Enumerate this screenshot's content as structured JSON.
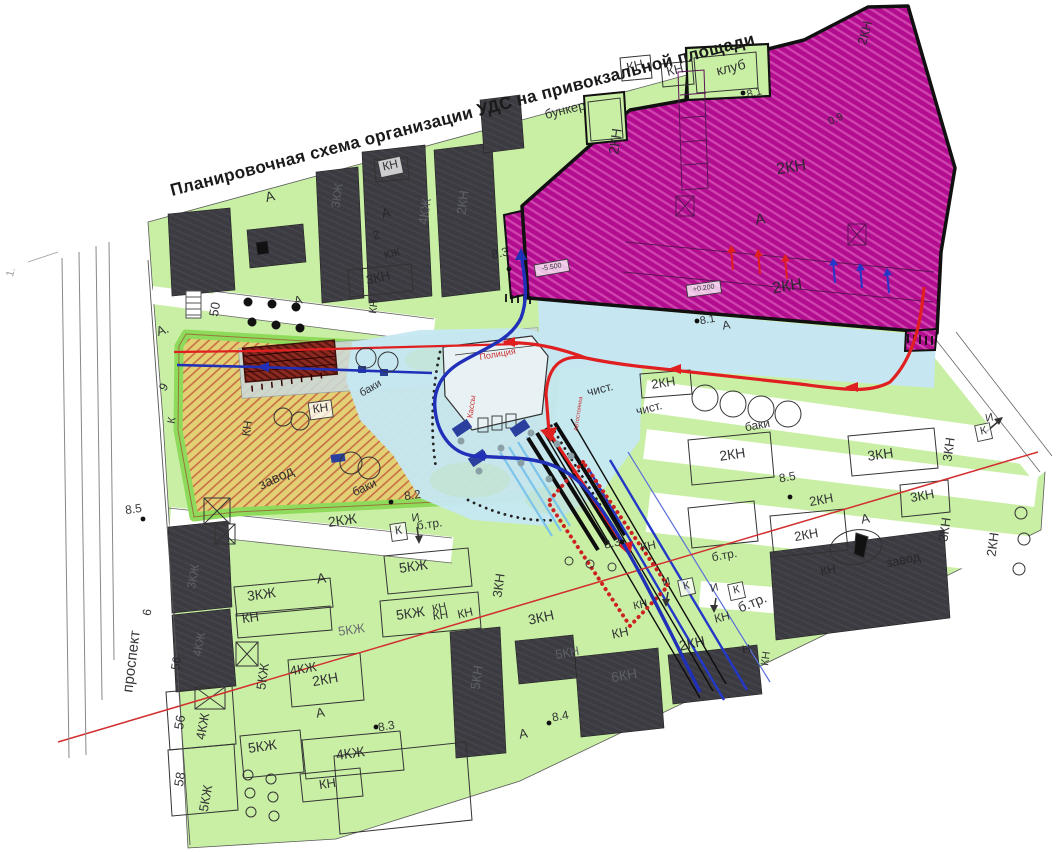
{
  "title": "Планировочная схема организации УДС на привокзальной площади",
  "colors": {
    "green_area": "#c9efa5",
    "magenta_zone": "#b10d8e",
    "magenta_stripe": "#cf43ae",
    "dark_building": "#3b3b41",
    "factory_yellow": "#e3cf74",
    "factory_hatch_red": "#c2563a",
    "plaza_blue": "#c6e7f1",
    "route_red": "#e02020",
    "route_blue": "#2030b8",
    "rail_black": "#0d0d0d",
    "fence_red_chain": "#cc2222",
    "label_ink": "#26262a"
  },
  "map": {
    "labels": [
      {
        "t": "клуб",
        "x": 732,
        "y": 72,
        "r": -14,
        "s": 14
      },
      {
        "t": "КН",
        "x": 636,
        "y": 70,
        "r": -14,
        "s": 13
      },
      {
        "t": "КН",
        "x": 676,
        "y": 74,
        "r": -14,
        "s": 13
      },
      {
        "t": "8.1",
        "x": 755,
        "y": 96,
        "r": -14,
        "s": 11
      },
      {
        "t": "бункер",
        "x": 566,
        "y": 114,
        "r": -14,
        "s": 13
      },
      {
        "t": "2КН",
        "x": 620,
        "y": 142,
        "r": -82,
        "s": 14
      },
      {
        "t": "2КН",
        "x": 869,
        "y": 34,
        "r": -75,
        "s": 13
      },
      {
        "t": "0.9",
        "x": 837,
        "y": 122,
        "r": -24,
        "s": 11
      },
      {
        "t": "2КН",
        "x": 792,
        "y": 172,
        "r": -9,
        "s": 16
      },
      {
        "t": "А",
        "x": 761,
        "y": 224,
        "r": -9,
        "s": 15
      },
      {
        "t": "2КН",
        "x": 788,
        "y": 291,
        "r": -9,
        "s": 16
      },
      {
        "t": "8.1",
        "x": 708,
        "y": 323,
        "r": -10,
        "s": 11
      },
      {
        "t": "А",
        "x": 727,
        "y": 329,
        "r": -10,
        "s": 12
      },
      {
        "t": "8.3",
        "x": 501,
        "y": 257,
        "r": -14,
        "s": 12
      },
      {
        "t": "2КН",
        "x": 664,
        "y": 387,
        "r": -9,
        "s": 13
      },
      {
        "t": "чист.",
        "x": 601,
        "y": 393,
        "r": -14,
        "s": 12
      },
      {
        "t": "чист.",
        "x": 650,
        "y": 412,
        "r": -14,
        "s": 12
      },
      {
        "t": "баки",
        "x": 758,
        "y": 429,
        "r": -10,
        "s": 12
      },
      {
        "t": "3КН",
        "x": 881,
        "y": 459,
        "r": -8,
        "s": 14
      },
      {
        "t": "2КН",
        "x": 733,
        "y": 459,
        "r": -8,
        "s": 14
      },
      {
        "t": "8.5",
        "x": 788,
        "y": 481,
        "r": -10,
        "s": 12
      },
      {
        "t": "2КН",
        "x": 822,
        "y": 504,
        "r": -10,
        "s": 13
      },
      {
        "t": "3КН",
        "x": 923,
        "y": 500,
        "r": -10,
        "s": 13
      },
      {
        "t": "3КН",
        "x": 953,
        "y": 450,
        "r": -82,
        "s": 13
      },
      {
        "t": "3КН",
        "x": 949,
        "y": 530,
        "r": -82,
        "s": 13
      },
      {
        "t": "2КН",
        "x": 997,
        "y": 545,
        "r": -82,
        "s": 13
      },
      {
        "t": "А",
        "x": 866,
        "y": 523,
        "r": -10,
        "s": 13
      },
      {
        "t": "завод",
        "x": 904,
        "y": 564,
        "r": -12,
        "s": 13
      },
      {
        "t": "КН",
        "x": 829,
        "y": 574,
        "r": -12,
        "s": 12
      },
      {
        "t": "2КН",
        "x": 807,
        "y": 539,
        "r": -10,
        "s": 13
      },
      {
        "t": "б.тр.",
        "x": 725,
        "y": 559,
        "r": -10,
        "s": 12
      },
      {
        "t": "КН",
        "x": 723,
        "y": 621,
        "r": -14,
        "s": 12
      },
      {
        "t": "б.тр.",
        "x": 754,
        "y": 607,
        "r": -22,
        "s": 14
      },
      {
        "t": "Н",
        "x": 747,
        "y": 653,
        "r": -10,
        "s": 12
      },
      {
        "t": "КН",
        "x": 769,
        "y": 659,
        "r": -82,
        "s": 11
      },
      {
        "t": "2КН",
        "x": 693,
        "y": 648,
        "r": -12,
        "s": 14
      },
      {
        "t": "6КН",
        "x": 625,
        "y": 680,
        "r": -10,
        "s": 14,
        "c": "dk"
      },
      {
        "t": "5КН",
        "x": 568,
        "y": 657,
        "r": -10,
        "s": 13,
        "c": "dk"
      },
      {
        "t": "5КН",
        "x": 481,
        "y": 678,
        "r": -82,
        "s": 13,
        "c": "dk"
      },
      {
        "t": "8.4",
        "x": 561,
        "y": 720,
        "r": -10,
        "s": 12
      },
      {
        "t": "А",
        "x": 524,
        "y": 738,
        "r": -10,
        "s": 13
      },
      {
        "t": "КН",
        "x": 621,
        "y": 637,
        "r": -12,
        "s": 13
      },
      {
        "t": "3КН",
        "x": 542,
        "y": 622,
        "r": -12,
        "s": 14
      },
      {
        "t": "КН",
        "x": 466,
        "y": 617,
        "r": -12,
        "s": 12
      },
      {
        "t": "КН",
        "x": 440,
        "y": 611,
        "r": -12,
        "s": 11
      },
      {
        "t": "3КН",
        "x": 503,
        "y": 586,
        "r": -82,
        "s": 13
      },
      {
        "t": "8.3",
        "x": 613,
        "y": 547,
        "r": -12,
        "s": 12
      },
      {
        "t": "КН",
        "x": 649,
        "y": 550,
        "r": -12,
        "s": 12
      },
      {
        "t": "КН",
        "x": 641,
        "y": 608,
        "r": -12,
        "s": 11
      },
      {
        "t": "И",
        "x": 667,
        "y": 585,
        "r": -12,
        "s": 11
      },
      {
        "t": "К",
        "x": 687,
        "y": 589,
        "r": -12,
        "s": 11,
        "box": 1
      },
      {
        "t": "И",
        "x": 715,
        "y": 591,
        "r": -12,
        "s": 11
      },
      {
        "t": "К",
        "x": 737,
        "y": 593,
        "r": -12,
        "s": 11,
        "box": 1
      },
      {
        "t": "б.тр.",
        "x": 430,
        "y": 528,
        "r": -8,
        "s": 12
      },
      {
        "t": "И",
        "x": 416,
        "y": 521,
        "r": -8,
        "s": 11
      },
      {
        "t": "К",
        "x": 399,
        "y": 534,
        "r": -8,
        "s": 12,
        "box": 1
      },
      {
        "t": "2КЖ",
        "x": 343,
        "y": 525,
        "r": -8,
        "s": 14
      },
      {
        "t": "8.5",
        "x": 134,
        "y": 513,
        "r": -8,
        "s": 12
      },
      {
        "t": "А",
        "x": 322,
        "y": 583,
        "r": -8,
        "s": 14
      },
      {
        "t": "5КЖ",
        "x": 414,
        "y": 571,
        "r": -8,
        "s": 14
      },
      {
        "t": "3КЖ",
        "x": 262,
        "y": 599,
        "r": -8,
        "s": 14
      },
      {
        "t": "КН",
        "x": 251,
        "y": 622,
        "r": -8,
        "s": 13
      },
      {
        "t": "5КЖ",
        "x": 411,
        "y": 618,
        "r": -8,
        "s": 14
      },
      {
        "t": "КН",
        "x": 441,
        "y": 619,
        "r": -8,
        "s": 12
      },
      {
        "t": "5КЖ",
        "x": 352,
        "y": 634,
        "r": -8,
        "s": 13,
        "c": "dk"
      },
      {
        "t": "2КН",
        "x": 326,
        "y": 684,
        "r": -10,
        "s": 14
      },
      {
        "t": "4КЖ",
        "x": 304,
        "y": 673,
        "r": -10,
        "s": 13
      },
      {
        "t": "5КЖ",
        "x": 267,
        "y": 677,
        "r": -82,
        "s": 13
      },
      {
        "t": "А",
        "x": 321,
        "y": 717,
        "r": -10,
        "s": 13
      },
      {
        "t": "8.3",
        "x": 387,
        "y": 730,
        "r": -10,
        "s": 12
      },
      {
        "t": "5КЖ",
        "x": 263,
        "y": 751,
        "r": -8,
        "s": 14
      },
      {
        "t": "4КЖ",
        "x": 351,
        "y": 758,
        "r": -8,
        "s": 14
      },
      {
        "t": "КН",
        "x": 328,
        "y": 788,
        "r": -8,
        "s": 13
      },
      {
        "t": "56",
        "x": 184,
        "y": 723,
        "r": -80,
        "s": 13
      },
      {
        "t": "4КЖ",
        "x": 207,
        "y": 727,
        "r": -80,
        "s": 13
      },
      {
        "t": "58",
        "x": 184,
        "y": 780,
        "r": -80,
        "s": 13
      },
      {
        "t": "5КЖ",
        "x": 210,
        "y": 799,
        "r": -80,
        "s": 13
      },
      {
        "t": "56",
        "x": 180,
        "y": 664,
        "r": -80,
        "s": 12
      },
      {
        "t": "3КЖ",
        "x": 197,
        "y": 577,
        "r": -80,
        "s": 12,
        "c": "dk"
      },
      {
        "t": "4КЖ",
        "x": 203,
        "y": 645,
        "r": -80,
        "s": 12,
        "c": "dk"
      },
      {
        "t": "проспект",
        "x": 136,
        "y": 662,
        "r": -83,
        "s": 15
      },
      {
        "t": "6",
        "x": 151,
        "y": 613,
        "r": -80,
        "s": 12
      },
      {
        "t": "А.",
        "x": 164,
        "y": 334,
        "r": -20,
        "s": 13
      },
      {
        "t": "9",
        "x": 167,
        "y": 389,
        "r": -60,
        "s": 12
      },
      {
        "t": "К",
        "x": 175,
        "y": 421,
        "r": -80,
        "s": 11
      },
      {
        "t": "50",
        "x": 219,
        "y": 310,
        "r": -80,
        "s": 13
      },
      {
        "t": "А",
        "x": 271,
        "y": 201,
        "r": -14,
        "s": 14
      },
      {
        "t": "А",
        "x": 387,
        "y": 217,
        "r": -14,
        "s": 13
      },
      {
        "t": "2",
        "x": 377,
        "y": 239,
        "r": -14,
        "s": 12
      },
      {
        "t": "КЖ",
        "x": 393,
        "y": 257,
        "r": -14,
        "s": 11
      },
      {
        "t": "4КЖ",
        "x": 429,
        "y": 212,
        "r": -82,
        "s": 13,
        "c": "dk"
      },
      {
        "t": "2КН",
        "x": 467,
        "y": 203,
        "r": -82,
        "s": 13,
        "c": "dk"
      },
      {
        "t": "3КЖ",
        "x": 341,
        "y": 196,
        "r": -82,
        "s": 12,
        "c": "dk"
      },
      {
        "t": "КН",
        "x": 391,
        "y": 169,
        "r": -12,
        "s": 12,
        "box": 1
      },
      {
        "t": "3КН",
        "x": 379,
        "y": 282,
        "r": -12,
        "s": 13
      },
      {
        "t": "КН",
        "x": 377,
        "y": 307,
        "r": -82,
        "s": 11
      },
      {
        "t": "А",
        "x": 299,
        "y": 304,
        "r": -14,
        "s": 12
      },
      {
        "t": "Полиция",
        "x": 498,
        "y": 357,
        "r": -10,
        "s": 9,
        "c": "red"
      },
      {
        "t": "Кассы",
        "x": 474,
        "y": 407,
        "r": -82,
        "s": 8,
        "c": "red"
      },
      {
        "t": "Автостоянка",
        "x": 580,
        "y": 414,
        "r": -82,
        "s": 6,
        "c": "red"
      },
      {
        "t": "баки",
        "x": 372,
        "y": 391,
        "r": -30,
        "s": 11
      },
      {
        "t": "баки",
        "x": 366,
        "y": 491,
        "r": -25,
        "s": 12
      },
      {
        "t": "КН",
        "x": 321,
        "y": 412,
        "r": -8,
        "s": 12,
        "box": 1
      },
      {
        "t": "КН",
        "x": 251,
        "y": 429,
        "r": -82,
        "s": 12
      },
      {
        "t": "завод",
        "x": 278,
        "y": 482,
        "r": -25,
        "s": 14
      },
      {
        "t": "8.2",
        "x": 413,
        "y": 499,
        "r": -8,
        "s": 12
      },
      {
        "t": "1.",
        "x": 14,
        "y": 273,
        "r": -75,
        "s": 11,
        "c": "faint"
      },
      {
        "t": "И",
        "x": 990,
        "y": 421,
        "r": -12,
        "s": 11
      },
      {
        "t": "К",
        "x": 984,
        "y": 434,
        "r": -12,
        "s": 11,
        "box": 1
      },
      {
        "t": "-5.500",
        "x": 552,
        "y": 269,
        "r": -10,
        "s": 7,
        "box": 1
      },
      {
        "t": "+0.200",
        "x": 704,
        "y": 290,
        "r": -8,
        "s": 7,
        "box": 1
      }
    ],
    "elev_dots": [
      [
        743,
        93
      ],
      [
        697,
        321
      ],
      [
        509,
        269
      ],
      [
        790,
        497
      ],
      [
        549,
        723
      ],
      [
        622,
        542
      ],
      [
        143,
        519
      ],
      [
        376,
        727
      ],
      [
        391,
        502
      ]
    ],
    "tree_dots": [
      [
        248,
        302
      ],
      [
        272,
        304
      ],
      [
        296,
        307
      ],
      [
        252,
        322
      ],
      [
        276,
        325
      ],
      [
        300,
        328
      ]
    ],
    "circles": [
      [
        705,
        398,
        13
      ],
      [
        733,
        404,
        13
      ],
      [
        761,
        409,
        13
      ],
      [
        788,
        414,
        13
      ],
      [
        366,
        358,
        10
      ],
      [
        388,
        362,
        10
      ],
      [
        283,
        417,
        9
      ],
      [
        300,
        421,
        9
      ],
      [
        351,
        463,
        11
      ],
      [
        369,
        468,
        11
      ],
      [
        1021,
        513,
        6
      ],
      [
        1024,
        539,
        6
      ],
      [
        1019,
        569,
        6
      ],
      [
        248,
        775,
        5
      ],
      [
        271,
        779,
        5
      ],
      [
        250,
        793,
        5
      ],
      [
        273,
        797,
        5
      ],
      [
        251,
        812,
        5
      ],
      [
        274,
        816,
        5
      ],
      [
        569,
        561,
        4
      ],
      [
        590,
        564,
        4
      ],
      [
        612,
        567,
        4
      ]
    ],
    "people_dots": [
      [
        531,
        433
      ],
      [
        557,
        444
      ],
      [
        521,
        463
      ],
      [
        479,
        471
      ],
      [
        549,
        479
      ],
      [
        571,
        456
      ],
      [
        501,
        448
      ],
      [
        461,
        441
      ]
    ]
  }
}
